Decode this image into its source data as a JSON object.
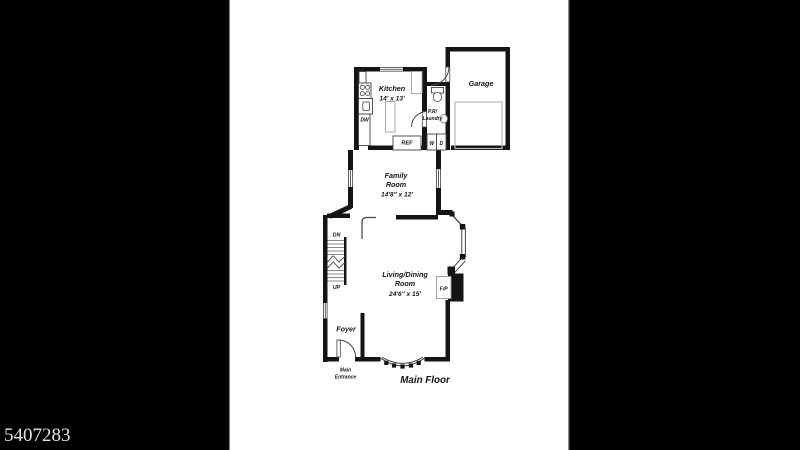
{
  "watermark": {
    "id": "5407283"
  },
  "plan": {
    "title": "Main Floor",
    "rooms": {
      "kitchen": {
        "name": "Kitchen",
        "dims": "14' x 13'"
      },
      "garage": {
        "name": "Garage"
      },
      "powder": {
        "line1": "P.R/",
        "line2": "Laundry"
      },
      "family": {
        "line1": "Family",
        "line2": "Room",
        "dims": "14'8\" x 12'"
      },
      "living": {
        "line1": "Living/Dining",
        "line2": "Room",
        "dims": "24'6\" x 15'"
      },
      "foyer": {
        "name": "Foyer"
      }
    },
    "labels": {
      "dw": "DW",
      "ref": "REF",
      "washer": "W",
      "dryer": "D",
      "dn": "DN",
      "up": "UP",
      "fp": "F/P",
      "entrance1": "Main",
      "entrance2": "Entrance"
    },
    "colors": {
      "background": "#000000",
      "paper": "#ffffff",
      "wall": "#141414"
    }
  }
}
